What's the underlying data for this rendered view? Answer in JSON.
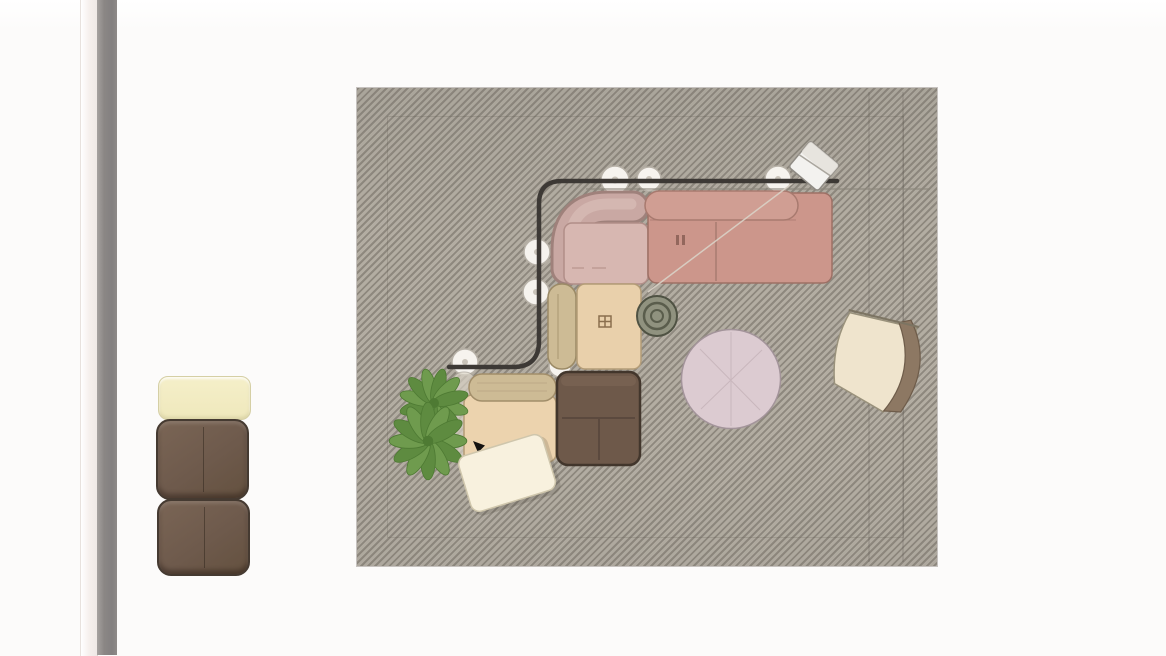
{
  "app": {
    "title": "furniture layout viewport"
  },
  "icons": {
    "stitch_tag": "stitch-tag-icon",
    "grid_tag": "grid-tag-icon",
    "cursor": "cursor-icon"
  },
  "scene": {
    "rug": "striped area rug",
    "objects": [
      "corner sofa backrest",
      "pink seat cushion",
      "salmon sofa section",
      "salmon backrest pill",
      "khaki backrest pill",
      "beige seat cushion",
      "beige armchair",
      "brown ottoman",
      "spiral trivet",
      "round pink rug",
      "lounge chair",
      "potted plant",
      "white board",
      "white cube table",
      "black rail",
      "caster wheels"
    ],
    "swatches": [
      "cream cushion",
      "brown cushion",
      "brown cushion"
    ]
  },
  "colors": {
    "carpet_dark": "#8e887e",
    "carpet_light": "#b3ada2",
    "frame_gray": "#8b8785",
    "swatch_cream": "#f2ecc3",
    "swatch_brown": "#6e5a4c",
    "sofa_corner": "#c9a8a3",
    "sofa_corner_shadow": "#9f817b",
    "seat_pink": "#d7b7b1",
    "sofa_salmon": "#cc968b",
    "pill_salmon": "#d09e93",
    "pill_khaki": "#cdbb95",
    "seat_beige": "#e9d0ab",
    "armchair_beige": "#ecd3ae",
    "ottoman_brown": "#6e594a",
    "trivet_green": "#90927f",
    "round_rug_pink": "#dccbd1",
    "chair_seat_cream": "#efe4cd",
    "chair_back_taupe": "#8d7863",
    "plant_green": "#6f9b4e",
    "plant_green_dark": "#5e8b40",
    "rail_black": "#3d3935",
    "caster_white": "#f6f3ee",
    "paper_white": "#f8f1de",
    "cube_white": "#f3f2ef"
  }
}
